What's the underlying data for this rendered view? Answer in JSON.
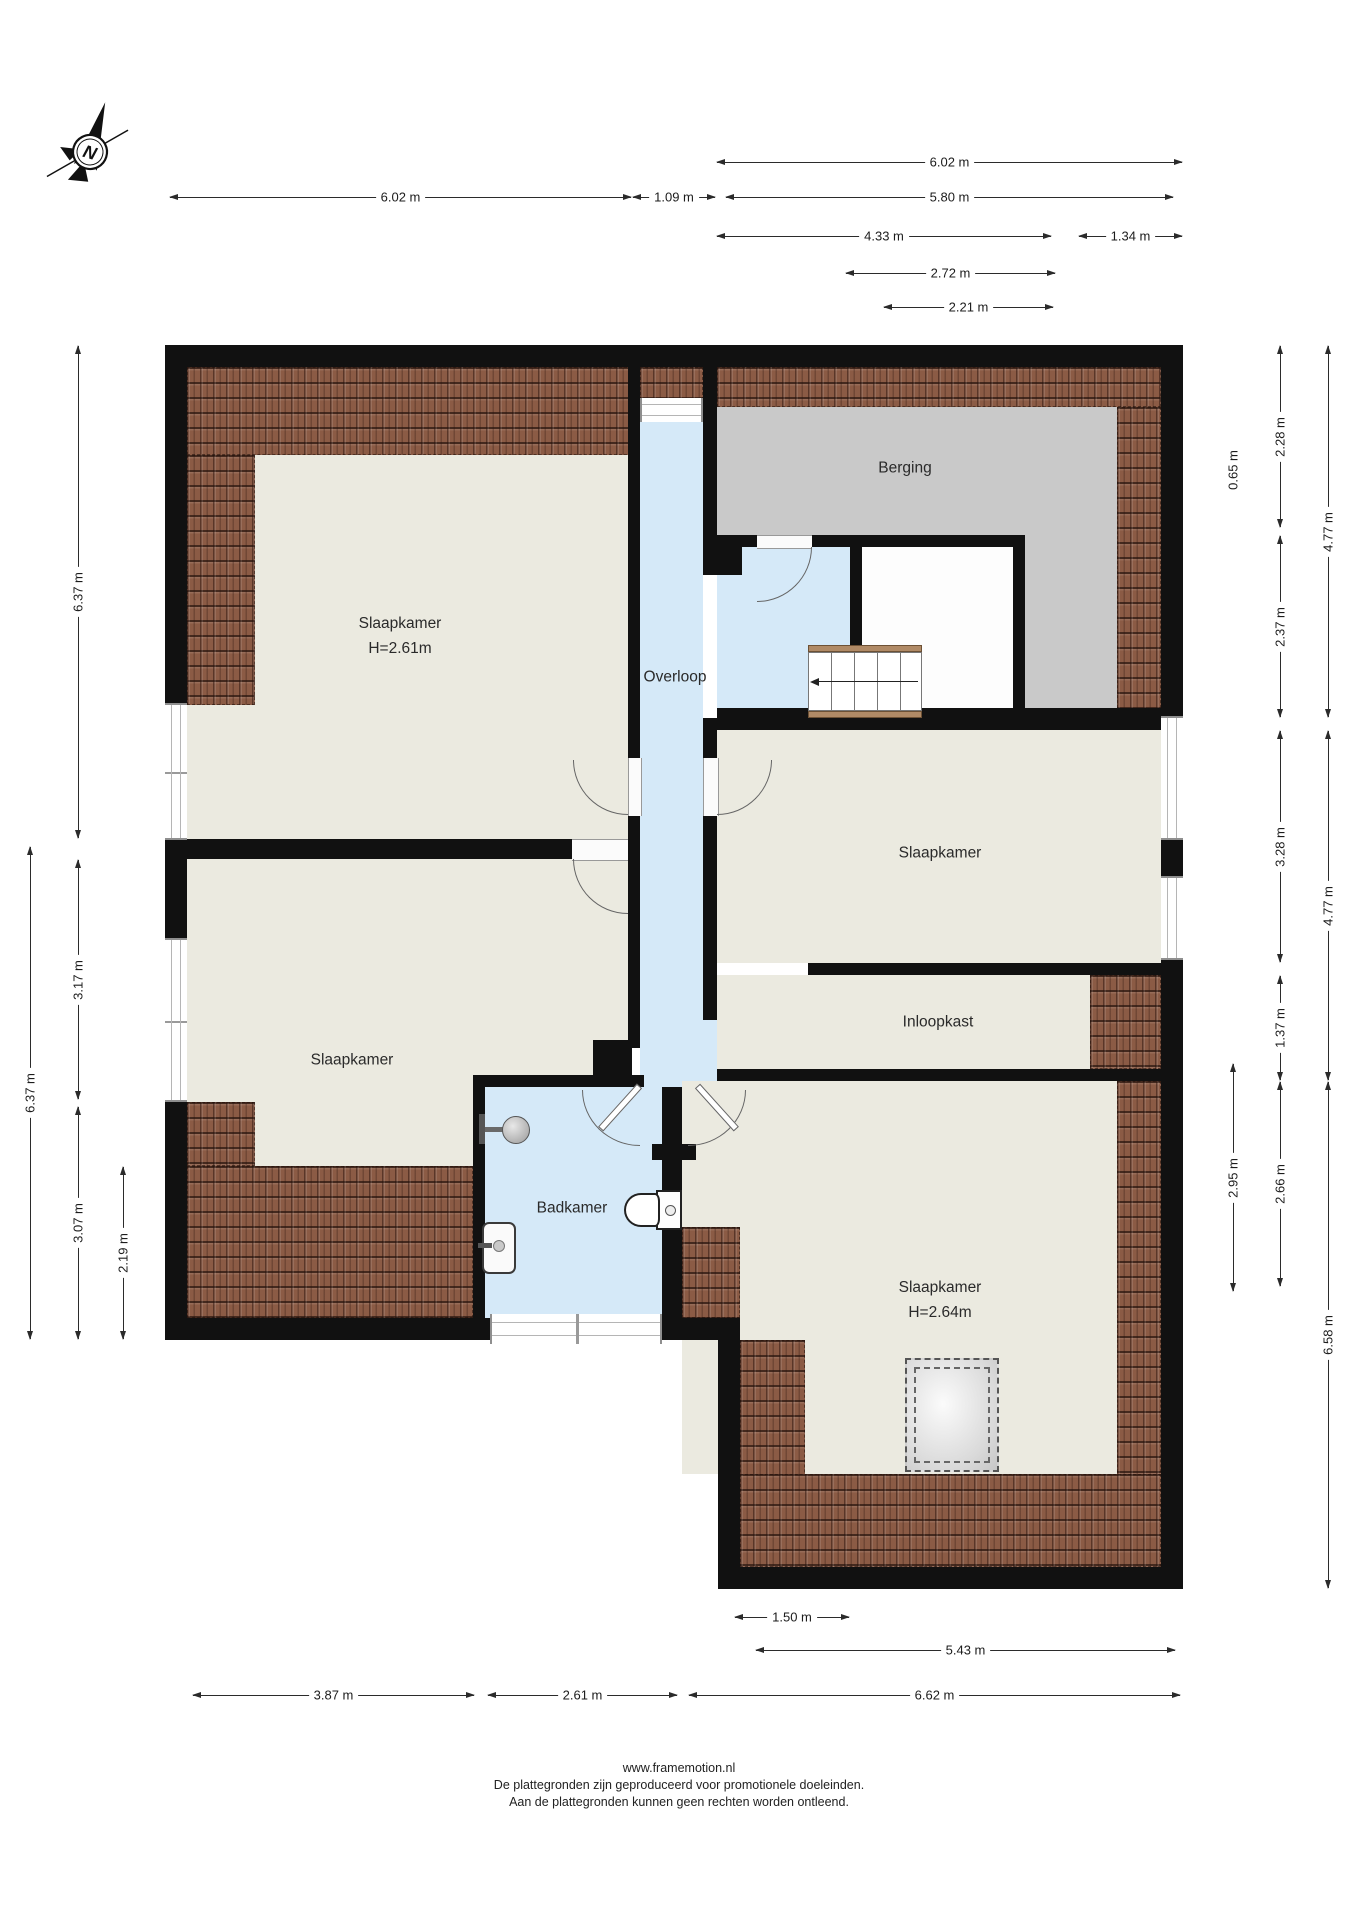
{
  "compass": {
    "label": "N"
  },
  "colors": {
    "floor_beige": "#ebeae0",
    "floor_blue": "#d5e9f8",
    "floor_gray": "#c9c9c9",
    "roof_tile_brown": "#8b5b45",
    "wall_black": "#111111"
  },
  "rooms": [
    {
      "id": "slaapkamer-topleft",
      "label": "Slaapkamer",
      "sub": "H=2.61m",
      "x": 400,
      "y": 636
    },
    {
      "id": "berging",
      "label": "Berging",
      "sub": "",
      "x": 905,
      "y": 468
    },
    {
      "id": "overloop",
      "label": "Overloop",
      "sub": "",
      "x": 675,
      "y": 677
    },
    {
      "id": "slaapkamer-right",
      "label": "Slaapkamer",
      "sub": "",
      "x": 940,
      "y": 853
    },
    {
      "id": "inloopkast",
      "label": "Inloopkast",
      "sub": "",
      "x": 938,
      "y": 1022
    },
    {
      "id": "slaapkamer-bottomleft",
      "label": "Slaapkamer",
      "sub": "",
      "x": 352,
      "y": 1060
    },
    {
      "id": "badkamer",
      "label": "Badkamer",
      "sub": "",
      "x": 572,
      "y": 1208
    },
    {
      "id": "slaapkamer-bottomright",
      "label": "Slaapkamer",
      "sub": "H=2.64m",
      "x": 940,
      "y": 1300
    }
  ],
  "dimensions": [
    {
      "id": "top-602-right",
      "label": "6.02 m",
      "orient": "h",
      "x": 716,
      "y": 162,
      "length": 467
    },
    {
      "id": "top-602-left",
      "label": "6.02 m",
      "orient": "h",
      "x": 169,
      "y": 197,
      "length": 463
    },
    {
      "id": "top-109",
      "label": "1.09 m",
      "orient": "h",
      "x": 632,
      "y": 197,
      "length": 84
    },
    {
      "id": "top-580",
      "label": "5.80 m",
      "orient": "h",
      "x": 725,
      "y": 197,
      "length": 449
    },
    {
      "id": "top-433",
      "label": "4.33 m",
      "orient": "h",
      "x": 716,
      "y": 236,
      "length": 336
    },
    {
      "id": "top-134",
      "label": "1.34 m",
      "orient": "h",
      "x": 1078,
      "y": 236,
      "length": 105
    },
    {
      "id": "top-272",
      "label": "2.72 m",
      "orient": "h",
      "x": 845,
      "y": 273,
      "length": 211
    },
    {
      "id": "top-221",
      "label": "2.21 m",
      "orient": "h",
      "x": 883,
      "y": 307,
      "length": 171
    },
    {
      "id": "left-637-top",
      "label": "6.37 m",
      "orient": "v",
      "x": 78,
      "y": 345,
      "length": 494
    },
    {
      "id": "left-317",
      "label": "3.17 m",
      "orient": "v",
      "x": 78,
      "y": 859,
      "length": 241
    },
    {
      "id": "left-307",
      "label": "3.07 m",
      "orient": "v",
      "x": 78,
      "y": 1106,
      "length": 234
    },
    {
      "id": "left-637-bot",
      "label": "6.37 m",
      "orient": "v",
      "x": 30,
      "y": 846,
      "length": 494
    },
    {
      "id": "left-219",
      "label": "2.19 m",
      "orient": "v",
      "x": 123,
      "y": 1166,
      "length": 174
    },
    {
      "id": "right-228",
      "label": "2.28 m",
      "orient": "v",
      "x": 1280,
      "y": 345,
      "length": 183
    },
    {
      "id": "right-237",
      "label": "2.37 m",
      "orient": "v",
      "x": 1280,
      "y": 535,
      "length": 183
    },
    {
      "id": "right-328",
      "label": "3.28 m",
      "orient": "v",
      "x": 1280,
      "y": 730,
      "length": 233
    },
    {
      "id": "right-137",
      "label": "1.37 m",
      "orient": "v",
      "x": 1280,
      "y": 975,
      "length": 106
    },
    {
      "id": "right-266",
      "label": "2.66 m",
      "orient": "v",
      "x": 1280,
      "y": 1081,
      "length": 206
    },
    {
      "id": "right-477-top",
      "label": "4.77 m",
      "orient": "v",
      "x": 1328,
      "y": 345,
      "length": 373
    },
    {
      "id": "right-477-bot",
      "label": "4.77 m",
      "orient": "v",
      "x": 1328,
      "y": 730,
      "length": 351
    },
    {
      "id": "right-658",
      "label": "6.58 m",
      "orient": "v",
      "x": 1328,
      "y": 1081,
      "length": 508
    },
    {
      "id": "right-065",
      "label": "0.65 m",
      "orient": "v",
      "x": 1233,
      "y": 420,
      "length": 100,
      "label_only": true
    },
    {
      "id": "right-295",
      "label": "2.95 m",
      "orient": "v",
      "x": 1233,
      "y": 1063,
      "length": 229
    },
    {
      "id": "bot-150",
      "label": "1.50 m",
      "orient": "h",
      "x": 734,
      "y": 1617,
      "length": 116
    },
    {
      "id": "bot-543",
      "label": "5.43 m",
      "orient": "h",
      "x": 755,
      "y": 1650,
      "length": 421
    },
    {
      "id": "bot-387",
      "label": "3.87 m",
      "orient": "h",
      "x": 192,
      "y": 1695,
      "length": 283
    },
    {
      "id": "bot-261",
      "label": "2.61 m",
      "orient": "h",
      "x": 487,
      "y": 1695,
      "length": 191
    },
    {
      "id": "bot-662",
      "label": "6.62 m",
      "orient": "h",
      "x": 688,
      "y": 1695,
      "length": 493
    }
  ],
  "footer": {
    "line1": "www.framemotion.nl",
    "line2": "De plattegronden zijn geproduceerd voor promotionele doeleinden.",
    "line3": "Aan de plattegronden kunnen geen rechten worden ontleend."
  }
}
